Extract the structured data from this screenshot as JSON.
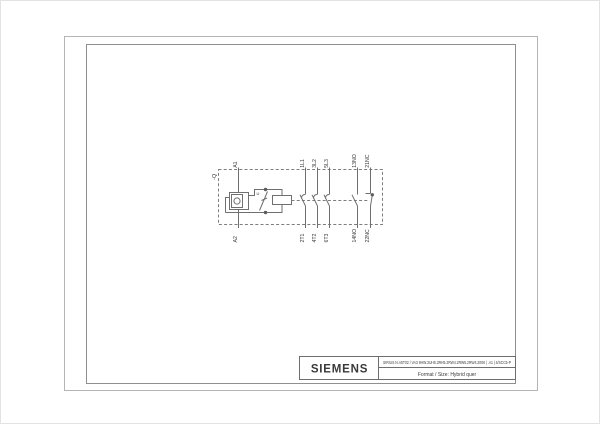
{
  "page": {
    "background": "#ffffff",
    "frame_color": "#a6a6a6",
    "line_color": "#6f6f6f",
    "text_color": "#3a3a3a"
  },
  "schematic": {
    "device_tag": "-Q",
    "suppressor_label": "U",
    "terminals": {
      "top": [
        "A1",
        "1L1",
        "3L2",
        "5L3",
        "13NO",
        "21NC"
      ],
      "bottom": [
        "A2",
        "2T1",
        "4T2",
        "6T3",
        "14NO",
        "22NC"
      ]
    }
  },
  "title_block": {
    "brand": "SIEMENS",
    "doc_reference": "SIRIUS N.A5T02 / VA3 9HW.3UH5.3RH5.2RW4.2RW5.2RW4.2006 | .A1 | 4/SCC5-P",
    "format_label": "Format / Size: Hybrid quer"
  }
}
